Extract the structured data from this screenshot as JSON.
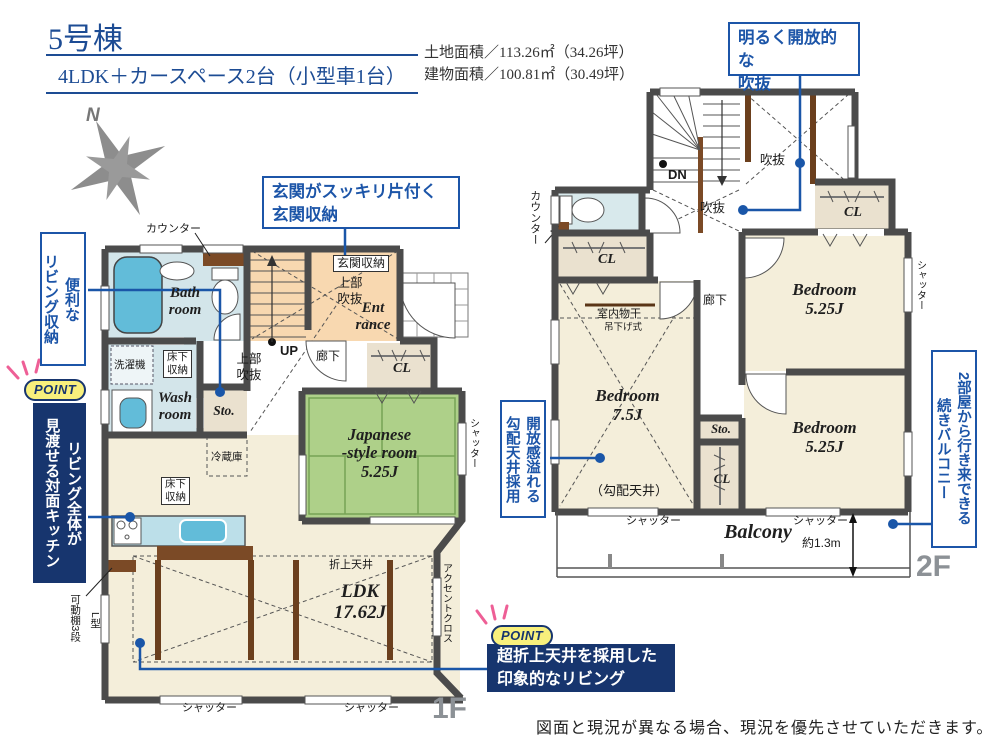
{
  "header": {
    "building": "5号棟",
    "plan": "4LDK＋カースペース2台（小型車1台）",
    "land_area": "土地面積／113.26㎡（34.26坪）",
    "building_area": "建物面積／100.81㎡（30.49坪）",
    "compass_n": "N"
  },
  "callouts": {
    "point_badge": "POINT",
    "void": "明るく開放的な\n吹抜",
    "entrance_storage": "玄関がスッキリ片付く\n玄関収納",
    "living_storage": "便利な\nリビング収納",
    "kitchen": "リビング全体が\n見渡せる対面キッチン",
    "ceiling": "超折上天井を採用した\n印象的なリビング",
    "sloped_ceiling": "開放感溢れる\n勾配天井採用",
    "balcony": "2部屋から行き来できる\n続きバルコニー"
  },
  "floor1": {
    "floor_label": "1F",
    "counter": "カウンター",
    "bath": "Bath\nroom",
    "washer": "洗濯機",
    "floor_storage_a": "床下\n収納",
    "wash": "Wash\nroom",
    "sto": "Sto.",
    "upper_void_a": "上部\n吹抜",
    "up": "UP",
    "entrance_storage": "玄関収納",
    "upper_void_b": "上部\n吹抜",
    "entrance": "Ent\nrance",
    "hallway": "廊下",
    "closet": "CL",
    "japanese_room": "Japanese\n-style room\n5.25J",
    "shutter_side": "シャッター",
    "fridge": "冷蔵庫",
    "floor_storage_b": "床下\n収納",
    "folded_ceiling": "折上天井",
    "ldk": "LDK\n17.62J",
    "accent_cloth": "アクセントクロス",
    "movable_shelf": "可動棚3段",
    "l_shape": "L型",
    "shutter_a": "シャッター",
    "shutter_b": "シャッター"
  },
  "floor2": {
    "floor_label": "2F",
    "counter": "カウンター",
    "dn": "DN",
    "void_a": "吹抜",
    "void_b": "吹抜",
    "closet_top": "CL",
    "hallway": "廊下",
    "indoor_laundry": "室内物干",
    "hanging": "吊下げ式",
    "bedroom_75": "Bedroom\n7.5J",
    "sloped_note": "（勾配天井）",
    "closet_left": "CL",
    "bedroom_a": "Bedroom\n5.25J",
    "bedroom_b": "Bedroom\n5.25J",
    "sto": "Sto.",
    "closet_mid": "CL",
    "shutter_side": "シャッター",
    "shutter_a": "シャッター",
    "shutter_b": "シャッター",
    "balcony": "Balcony",
    "depth": "約1.3m"
  },
  "footer": {
    "note": "図面と現況が異なる場合、現況を優先させていただきます。"
  }
}
